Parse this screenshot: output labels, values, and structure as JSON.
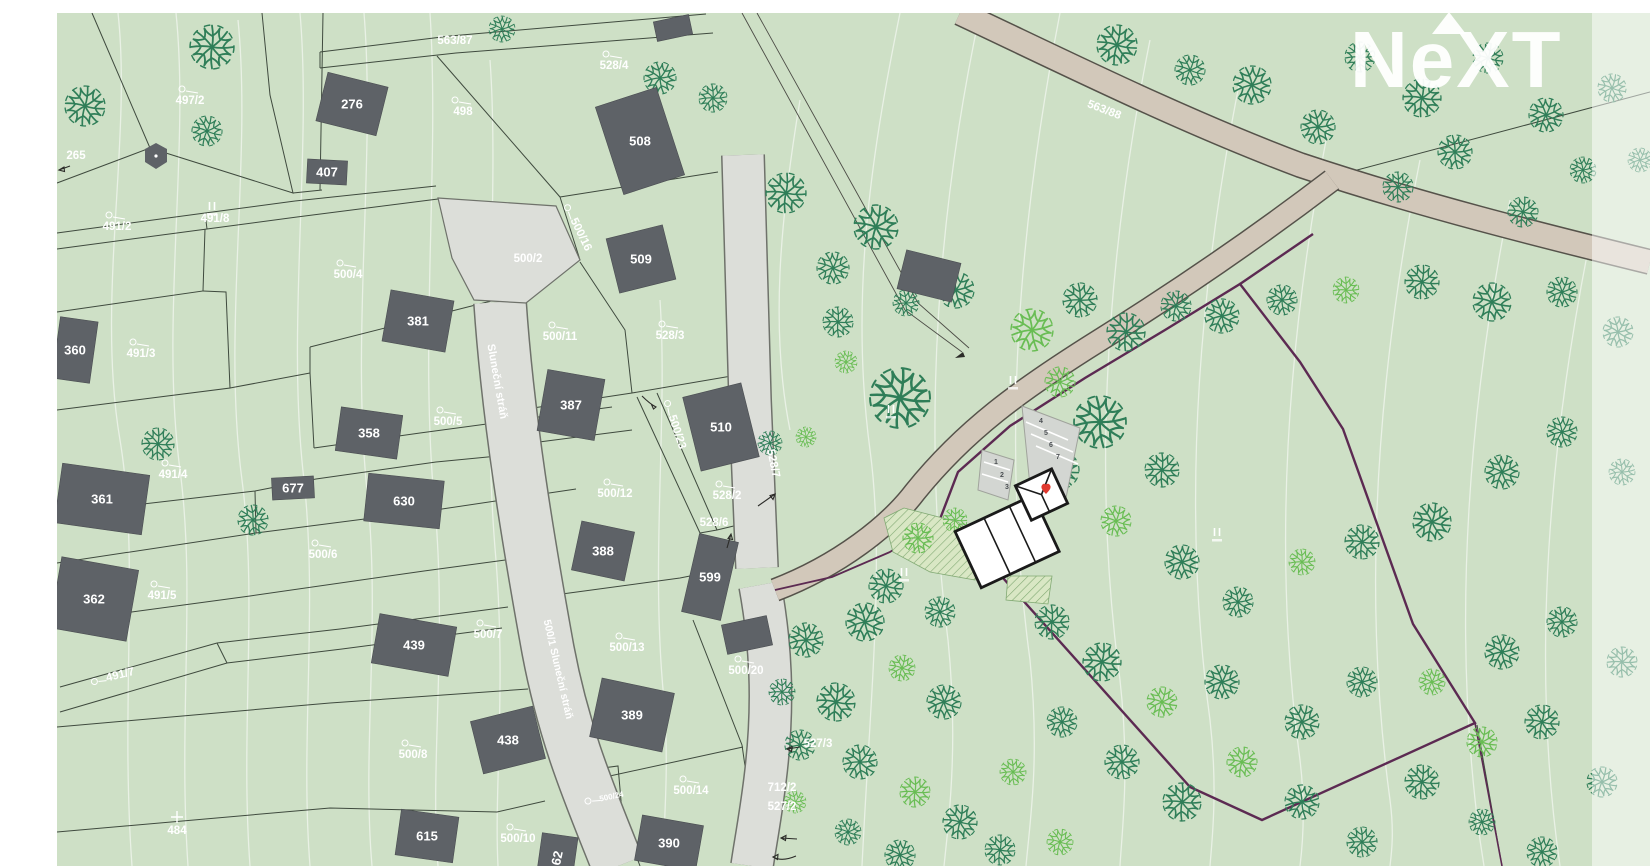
{
  "watermark": {
    "text": "NeXT"
  },
  "colors": {
    "map_green": "#cee0c6",
    "building_gray": "#5e6267",
    "road_tan": "#d2c8ba",
    "street_gray": "#dcded9",
    "boundary_purple": "#5c2a52",
    "marker_red": "#e0392f",
    "tree_dark": "#2f7e58",
    "tree_light": "#69bd54"
  },
  "street_names": [
    {
      "t": "Sluneční stráň",
      "x": 494,
      "y": 382,
      "r": 80,
      "s": "n",
      "fs": 11
    },
    {
      "t": "500/1 Sluneční stráň",
      "x": 555,
      "y": 670,
      "r": 77,
      "s": "n",
      "fs": 10.5
    }
  ],
  "labels": [
    {
      "t": "563/87",
      "x": 455,
      "y": 44,
      "s": "n"
    },
    {
      "t": "528/4",
      "x": 614,
      "y": 69,
      "s": "c"
    },
    {
      "t": "497/2",
      "x": 190,
      "y": 104,
      "s": "c"
    },
    {
      "t": "498",
      "x": 463,
      "y": 115,
      "s": "c"
    },
    {
      "t": "265",
      "x": 76,
      "y": 159,
      "s": "n"
    },
    {
      "t": "491/2",
      "x": 117,
      "y": 230,
      "s": "c"
    },
    {
      "t": "491/8",
      "x": 215,
      "y": 222,
      "s": "n"
    },
    {
      "t": "500/4",
      "x": 348,
      "y": 278,
      "s": "c"
    },
    {
      "t": "500/2",
      "x": 528,
      "y": 262,
      "s": "n"
    },
    {
      "t": "500/16",
      "x": 578,
      "y": 236,
      "r": 64,
      "s": "ci"
    },
    {
      "t": "563/88",
      "x": 1103,
      "y": 113,
      "r": 21,
      "s": "n"
    },
    {
      "t": "500/11",
      "x": 560,
      "y": 340,
      "s": "c"
    },
    {
      "t": "528/3",
      "x": 670,
      "y": 339,
      "s": "c"
    },
    {
      "t": "491/3",
      "x": 141,
      "y": 357,
      "s": "c"
    },
    {
      "t": "500/5",
      "x": 448,
      "y": 425,
      "s": "c"
    },
    {
      "t": "491/4",
      "x": 173,
      "y": 478,
      "s": "c"
    },
    {
      "t": "500/23",
      "x": 674,
      "y": 433,
      "r": 72,
      "s": "ci"
    },
    {
      "t": "528/7",
      "x": 770,
      "y": 464,
      "r": 78,
      "s": "n"
    },
    {
      "t": "500/12",
      "x": 615,
      "y": 497,
      "s": "c"
    },
    {
      "t": "528/2",
      "x": 727,
      "y": 499,
      "s": "c"
    },
    {
      "t": "528/6",
      "x": 714,
      "y": 526,
      "s": "n"
    },
    {
      "t": "500/6",
      "x": 323,
      "y": 558,
      "s": "c"
    },
    {
      "t": "491/5",
      "x": 162,
      "y": 599,
      "s": "c"
    },
    {
      "t": "500/7",
      "x": 488,
      "y": 638,
      "s": "c"
    },
    {
      "t": "500/13",
      "x": 627,
      "y": 651,
      "s": "c"
    },
    {
      "t": "491/7",
      "x": 121,
      "y": 678,
      "r": -14,
      "s": "ci"
    },
    {
      "t": "527/3",
      "x": 818,
      "y": 747,
      "s": "n"
    },
    {
      "t": "500/8",
      "x": 413,
      "y": 758,
      "s": "c"
    },
    {
      "t": "500/14",
      "x": 691,
      "y": 794,
      "s": "c"
    },
    {
      "t": "500/24",
      "x": 612,
      "y": 799,
      "r": -12,
      "s": "ci",
      "fs": 8
    },
    {
      "t": "484",
      "x": 177,
      "y": 834,
      "s": "x"
    },
    {
      "t": "500/10",
      "x": 518,
      "y": 842,
      "s": "c"
    },
    {
      "t": "712/2",
      "x": 782,
      "y": 791,
      "s": "n"
    },
    {
      "t": "527/2",
      "x": 782,
      "y": 810,
      "s": "n"
    },
    {
      "t": "500/20",
      "x": 746,
      "y": 674,
      "s": "c"
    }
  ],
  "buildings": [
    {
      "n": "276",
      "cx": 352,
      "cy": 104,
      "w": 62,
      "h": 50,
      "rot": 14
    },
    {
      "n": "407",
      "cx": 327,
      "cy": 172,
      "w": 40,
      "h": 24,
      "rot": 3
    },
    {
      "n": "",
      "cx": 673,
      "cy": 28,
      "w": 36,
      "h": 20,
      "rot": -12
    },
    {
      "n": "508",
      "cx": 640,
      "cy": 141,
      "w": 64,
      "h": 92,
      "rot": -18
    },
    {
      "n": "509",
      "cx": 641,
      "cy": 259,
      "w": 58,
      "h": 56,
      "rot": -14
    },
    {
      "n": "510",
      "cx": 721,
      "cy": 427,
      "w": 60,
      "h": 76,
      "rot": -14
    },
    {
      "n": "381",
      "cx": 418,
      "cy": 321,
      "w": 64,
      "h": 52,
      "rot": 10
    },
    {
      "n": "387",
      "cx": 571,
      "cy": 405,
      "w": 58,
      "h": 62,
      "rot": 10
    },
    {
      "n": "358",
      "cx": 369,
      "cy": 433,
      "w": 62,
      "h": 44,
      "rot": 8
    },
    {
      "n": "677",
      "cx": 293,
      "cy": 488,
      "w": 42,
      "h": 22,
      "rot": -3
    },
    {
      "n": "630",
      "cx": 404,
      "cy": 501,
      "w": 76,
      "h": 48,
      "rot": 6
    },
    {
      "n": "388",
      "cx": 603,
      "cy": 551,
      "w": 54,
      "h": 50,
      "rot": 12
    },
    {
      "n": "599",
      "cx": 710,
      "cy": 577,
      "w": 40,
      "h": 80,
      "rot": 13
    },
    {
      "n": "",
      "cx": 747,
      "cy": 635,
      "w": 46,
      "h": 30,
      "rot": -12
    },
    {
      "n": "360",
      "cx": 75,
      "cy": 350,
      "w": 38,
      "h": 62,
      "rot": 8
    },
    {
      "n": "361",
      "cx": 102,
      "cy": 499,
      "w": 88,
      "h": 60,
      "rot": 8
    },
    {
      "n": "362",
      "cx": 94,
      "cy": 599,
      "w": 78,
      "h": 72,
      "rot": 10
    },
    {
      "n": "439",
      "cx": 414,
      "cy": 645,
      "w": 78,
      "h": 50,
      "rot": 10
    },
    {
      "n": "438",
      "cx": 508,
      "cy": 740,
      "w": 64,
      "h": 54,
      "rot": -14
    },
    {
      "n": "389",
      "cx": 632,
      "cy": 715,
      "w": 74,
      "h": 60,
      "rot": 12
    },
    {
      "n": "615",
      "cx": 427,
      "cy": 836,
      "w": 58,
      "h": 46,
      "rot": 8
    },
    {
      "n": "390",
      "cx": 669,
      "cy": 843,
      "w": 62,
      "h": 46,
      "rot": 10
    },
    {
      "n": "62",
      "cx": 557,
      "cy": 858,
      "w": 36,
      "h": 46,
      "rot": 8,
      "lr": -78
    },
    {
      "n": "",
      "cx": 929,
      "cy": 276,
      "w": 56,
      "h": 40,
      "rot": 14
    }
  ],
  "parking": {
    "numbers": [
      {
        "t": "1",
        "x": 996,
        "y": 464
      },
      {
        "t": "2",
        "x": 1002,
        "y": 477
      },
      {
        "t": "3",
        "x": 1007,
        "y": 489
      },
      {
        "t": "4",
        "x": 1041,
        "y": 423
      },
      {
        "t": "5",
        "x": 1046,
        "y": 435
      },
      {
        "t": "6",
        "x": 1051,
        "y": 447
      },
      {
        "t": "7",
        "x": 1058,
        "y": 459
      }
    ]
  },
  "ticks": [
    [
      212,
      206
    ],
    [
      891,
      409
    ],
    [
      1013,
      380
    ],
    [
      904,
      572
    ],
    [
      1217,
      532
    ]
  ],
  "marker": {
    "x": 1046,
    "y": 489
  },
  "trees": [
    [
      212,
      47,
      22,
      "d"
    ],
    [
      85,
      106,
      20,
      "d"
    ],
    [
      207,
      131,
      15,
      "d"
    ],
    [
      502,
      29,
      13,
      "d"
    ],
    [
      660,
      78,
      16,
      "d"
    ],
    [
      713,
      98,
      14,
      "d"
    ],
    [
      786,
      193,
      20,
      "d"
    ],
    [
      876,
      227,
      22,
      "d"
    ],
    [
      833,
      268,
      16,
      "d"
    ],
    [
      956,
      290,
      18,
      "d"
    ],
    [
      906,
      303,
      13,
      "d"
    ],
    [
      838,
      322,
      15,
      "d"
    ],
    [
      900,
      398,
      30,
      "d"
    ],
    [
      846,
      362,
      11,
      "l"
    ],
    [
      770,
      443,
      12,
      "d"
    ],
    [
      806,
      437,
      10,
      "l"
    ],
    [
      253,
      520,
      15,
      "d"
    ],
    [
      158,
      444,
      16,
      "d"
    ],
    [
      1117,
      45,
      20,
      "d"
    ],
    [
      1190,
      70,
      15,
      "d"
    ],
    [
      1252,
      85,
      19,
      "d"
    ],
    [
      1318,
      127,
      17,
      "d"
    ],
    [
      1360,
      57,
      15,
      "d"
    ],
    [
      1422,
      98,
      19,
      "d"
    ],
    [
      1488,
      58,
      15,
      "d"
    ],
    [
      1546,
      115,
      17,
      "d"
    ],
    [
      1583,
      170,
      13,
      "d"
    ],
    [
      1455,
      152,
      17,
      "d"
    ],
    [
      1398,
      187,
      15,
      "d"
    ],
    [
      1523,
      212,
      15,
      "d"
    ],
    [
      1612,
      88,
      14,
      "d"
    ],
    [
      1640,
      160,
      12,
      "d"
    ],
    [
      1032,
      330,
      21,
      "l"
    ],
    [
      1080,
      300,
      17,
      "d"
    ],
    [
      1126,
      332,
      19,
      "d"
    ],
    [
      1176,
      306,
      15,
      "d"
    ],
    [
      1060,
      382,
      15,
      "l"
    ],
    [
      1222,
      316,
      17,
      "d"
    ],
    [
      1282,
      300,
      15,
      "d"
    ],
    [
      1346,
      290,
      13,
      "l"
    ],
    [
      1422,
      282,
      17,
      "d"
    ],
    [
      1492,
      302,
      19,
      "d"
    ],
    [
      1562,
      292,
      15,
      "d"
    ],
    [
      1618,
      332,
      15,
      "d"
    ],
    [
      1100,
      422,
      26,
      "d"
    ],
    [
      1162,
      470,
      17,
      "d"
    ],
    [
      1060,
      470,
      19,
      "d"
    ],
    [
      1116,
      521,
      15,
      "l"
    ],
    [
      1182,
      562,
      17,
      "d"
    ],
    [
      1238,
      602,
      15,
      "d"
    ],
    [
      1302,
      562,
      13,
      "l"
    ],
    [
      1362,
      542,
      17,
      "d"
    ],
    [
      1432,
      522,
      19,
      "d"
    ],
    [
      1502,
      472,
      17,
      "d"
    ],
    [
      1562,
      432,
      15,
      "d"
    ],
    [
      1622,
      472,
      13,
      "d"
    ],
    [
      1052,
      622,
      17,
      "d"
    ],
    [
      1102,
      662,
      19,
      "d"
    ],
    [
      1162,
      702,
      15,
      "l"
    ],
    [
      1222,
      682,
      17,
      "d"
    ],
    [
      1062,
      722,
      15,
      "d"
    ],
    [
      1122,
      762,
      17,
      "d"
    ],
    [
      1182,
      802,
      19,
      "d"
    ],
    [
      1242,
      762,
      15,
      "l"
    ],
    [
      1302,
      722,
      17,
      "d"
    ],
    [
      1362,
      682,
      15,
      "d"
    ],
    [
      1302,
      802,
      17,
      "d"
    ],
    [
      1362,
      842,
      15,
      "d"
    ],
    [
      1422,
      782,
      17,
      "d"
    ],
    [
      1482,
      742,
      15,
      "l"
    ],
    [
      1432,
      682,
      13,
      "l"
    ],
    [
      1502,
      652,
      17,
      "d"
    ],
    [
      1562,
      622,
      15,
      "d"
    ],
    [
      1622,
      662,
      15,
      "d"
    ],
    [
      1542,
      722,
      17,
      "d"
    ],
    [
      1602,
      782,
      15,
      "d"
    ],
    [
      1482,
      822,
      13,
      "d"
    ],
    [
      1542,
      852,
      15,
      "d"
    ],
    [
      918,
      538,
      15,
      "l"
    ],
    [
      955,
      520,
      12,
      "l"
    ],
    [
      886,
      586,
      17,
      "d"
    ],
    [
      940,
      612,
      15,
      "d"
    ],
    [
      865,
      622,
      19,
      "d"
    ],
    [
      806,
      640,
      17,
      "d"
    ],
    [
      782,
      692,
      13,
      "d"
    ],
    [
      836,
      702,
      19,
      "d"
    ],
    [
      902,
      668,
      13,
      "l"
    ],
    [
      944,
      702,
      17,
      "d"
    ],
    [
      800,
      745,
      15,
      "d"
    ],
    [
      860,
      762,
      17,
      "d"
    ],
    [
      915,
      792,
      15,
      "l"
    ],
    [
      960,
      822,
      17,
      "d"
    ],
    [
      848,
      832,
      13,
      "d"
    ],
    [
      900,
      855,
      15,
      "d"
    ],
    [
      795,
      802,
      11,
      "l"
    ],
    [
      1013,
      772,
      13,
      "l"
    ],
    [
      1000,
      850,
      15,
      "d"
    ],
    [
      1060,
      842,
      13,
      "l"
    ]
  ]
}
